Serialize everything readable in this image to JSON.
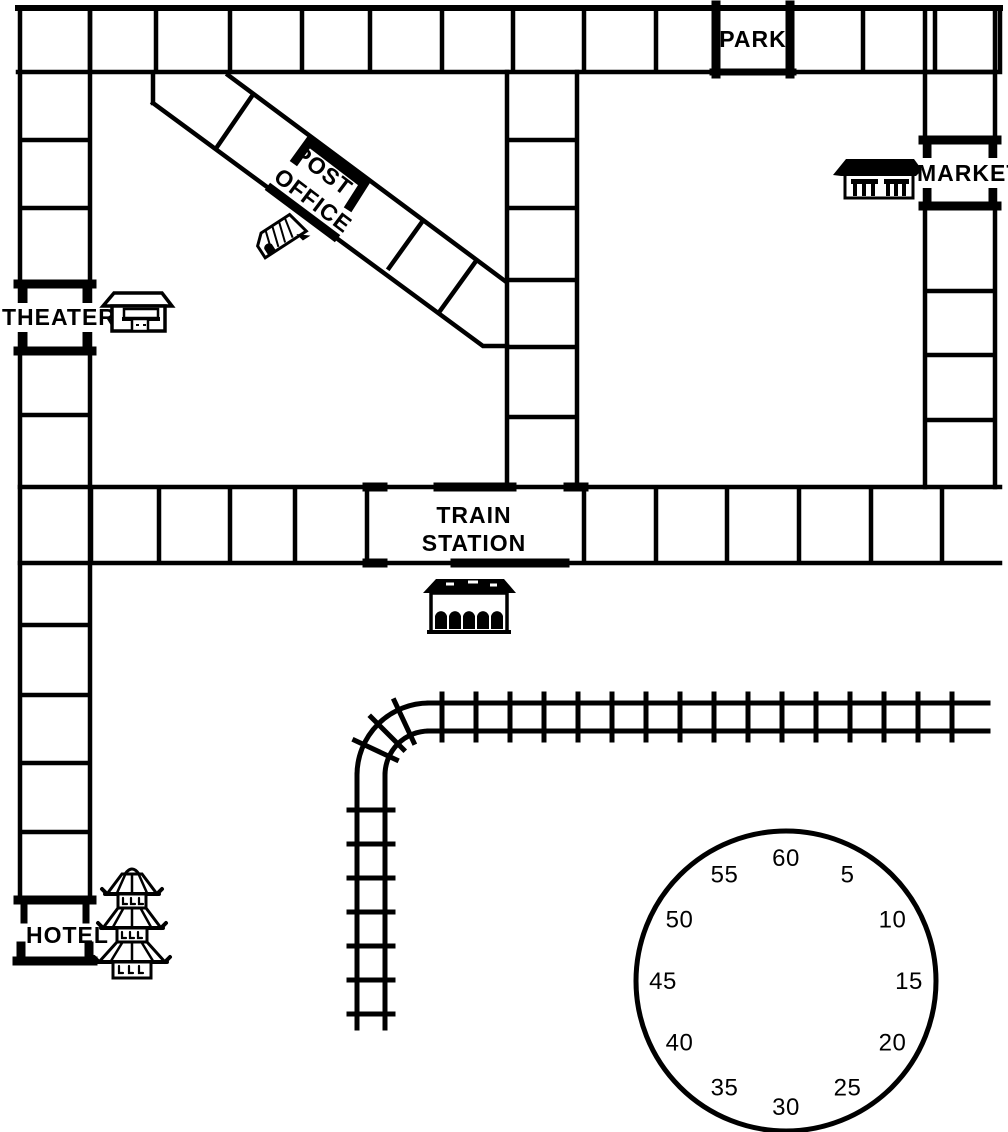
{
  "board": {
    "title_hint": "town game board",
    "locations": {
      "park": "PARK",
      "market": "MARKET",
      "theater": "THEATER",
      "hotel": "HOTEL",
      "train_station_line1": "TRAIN",
      "train_station_line2": "STATION",
      "post_office_line1": "POST",
      "post_office_line2": "OFFICE"
    },
    "icons": {
      "theater": "theater-building-icon",
      "market": "market-stall-icon",
      "post_office": "mail-truck-icon",
      "train_station": "station-building-icon",
      "hotel": "pagoda-icon",
      "railroad": "railroad-track",
      "timer": "timer-wheel"
    }
  },
  "timer": {
    "numbers": [
      "60",
      "5",
      "10",
      "15",
      "20",
      "25",
      "30",
      "35",
      "40",
      "45",
      "50",
      "55"
    ]
  },
  "colors": {
    "line": "#000000",
    "background": "#ffffff"
  }
}
